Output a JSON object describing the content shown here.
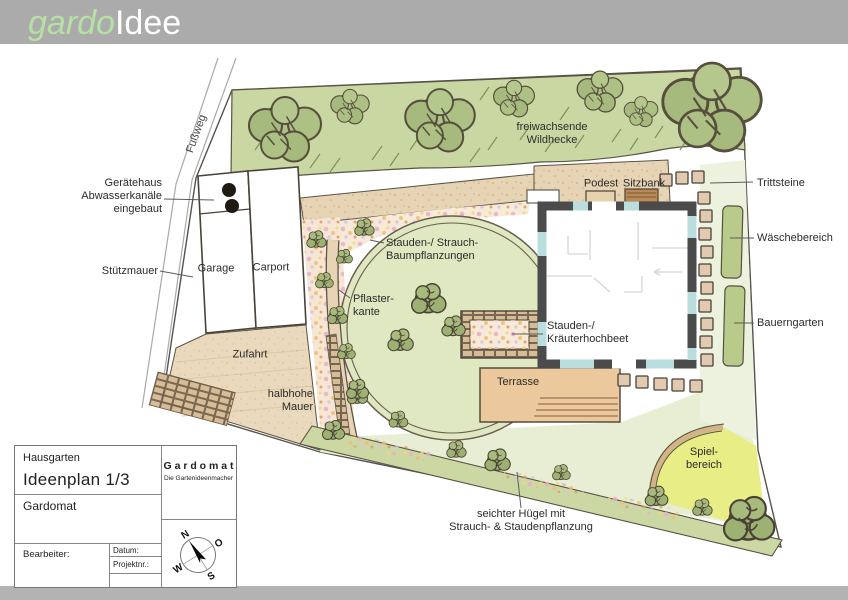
{
  "logo": {
    "brand_green": "gardo",
    "brand_gray": "Idee"
  },
  "plan": {
    "fussweg": "Fußweg",
    "wildhecke": "freiwachsende\nWildhecke",
    "geraetehaus": "Gerätehaus\nAbwasserkanäle\neingebaut",
    "stuetzmauer": "Stützmauer",
    "garage": "Garage",
    "carport": "Carport",
    "stauden_strauch": "Stauden-/ Strauch-\nBaumpflanzungen",
    "pflasterkante": "Pflaster-\nkante",
    "zufahrt": "Zufahrt",
    "halbhohe_mauer": "halbhohe\nMauer",
    "podest": "Podest",
    "sitzbank": "Sitzbank",
    "trittsteine": "Trittsteine",
    "waeschebereich": "Wäschebereich",
    "bauerngarten": "Bauerngarten",
    "kraeuterhochbeet": "Stauden-/\nKräuterhochbeet",
    "terrasse": "Terrasse",
    "spielbereich": "Spiel-\nbereich",
    "huegel": "seichter Hügel mit\nStrauch- & Staudenpflanzung"
  },
  "title_block": {
    "project_type": "Hausgarten",
    "plan_title": "Ideenplan 1/3",
    "client": "Gardomat",
    "bearbeiter_label": "Bearbeiter:",
    "datum_label": "Datum:",
    "projektnr_label": "Projektnr.:",
    "company_name": "G a r d o m a t",
    "company_tagline": "Die Gartenideenmacher"
  },
  "compass": {
    "n": "N",
    "e": "O",
    "s": "S",
    "w": "W"
  },
  "colors": {
    "header_bar": "#ababab",
    "logo_green": "#b5e2a3",
    "hedge_green": "#c9d8a3",
    "lawn_green": "#dfe8c1",
    "path_tan": "#e7d4b4",
    "terrace_tan": "#ecc99d",
    "play_yellow": "#e9ed85",
    "house_wall": "#4b4b4b",
    "window_blue": "#b9dedd"
  }
}
